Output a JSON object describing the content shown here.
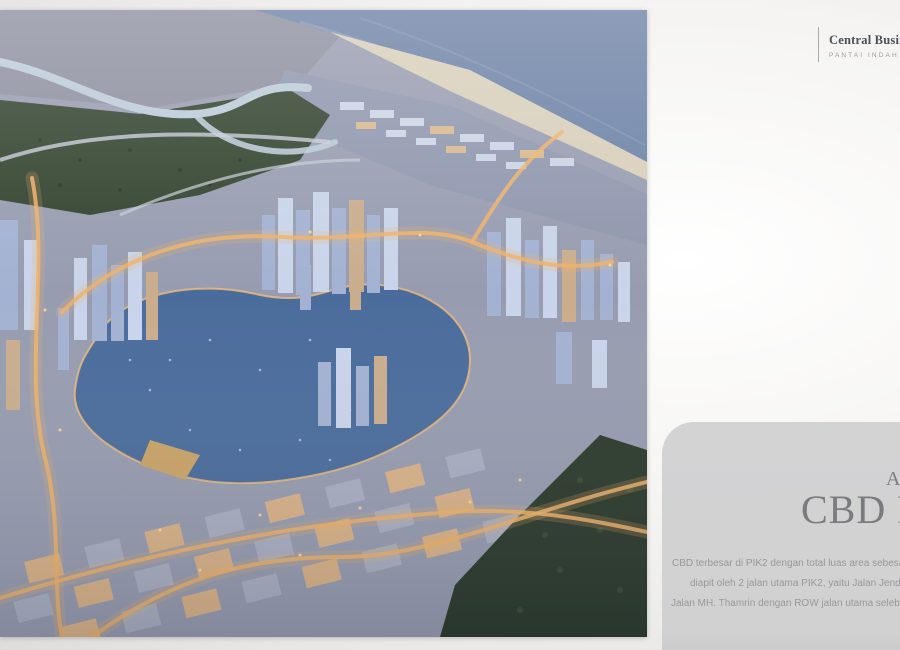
{
  "logo": {
    "title": "Central Business",
    "subtitle": "PANTAI INDAH",
    "divider_color": "#a9a9a9",
    "title_color": "#4a5058",
    "subtitle_color": "#9b9b9b"
  },
  "hero_image": {
    "name": "cbd-pik2-aerial-dusk-render",
    "palette": {
      "ocean": "#6d82a6",
      "beach": "#d8cfba",
      "estate": "#8d8f9f",
      "forest": "#33432f",
      "city_base": "#979cb0",
      "lagoon": "#4a6c9c",
      "waterfront_glow": "#f0bd79",
      "road_glow": "#eeb269",
      "coastal_band": "#8f97ae",
      "river": "#bccbd8",
      "trees_dark": "#2c3a2c"
    }
  },
  "info_card": {
    "background_color": "#d2d2d3",
    "eyebrow": "A",
    "title": "CBD P",
    "title_color": "#7a7b7e",
    "body_color": "#98989c",
    "body_lines": [
      "CBD terbesar di PIK2 dengan total luas area sebesar",
      "diapit oleh 2 jalan utama PIK2, yaitu Jalan Jend",
      "Jalan MH. Thamrin dengan ROW jalan utama seleb"
    ]
  }
}
